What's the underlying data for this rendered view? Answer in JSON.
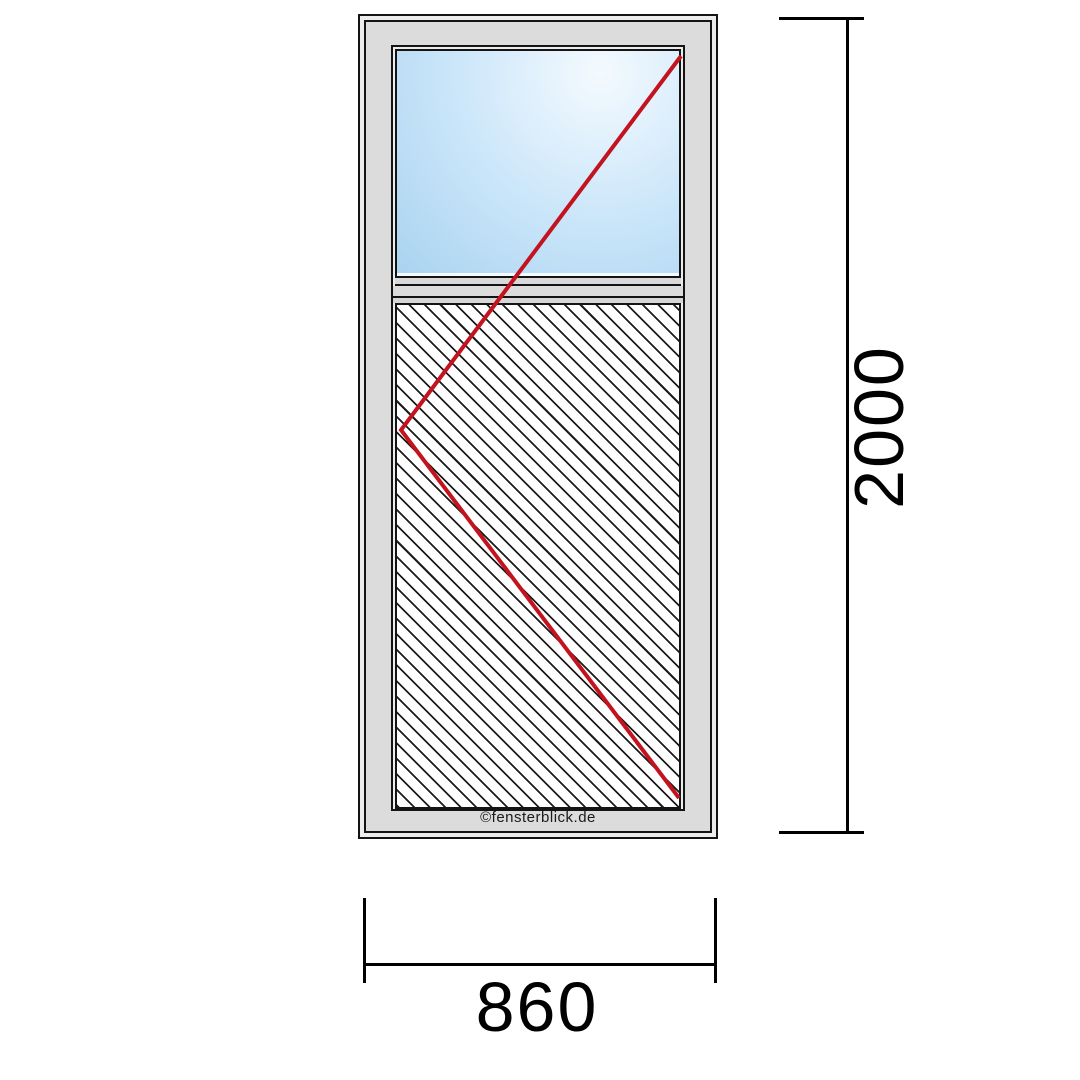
{
  "drawing": {
    "type": "window-element-technical-drawing",
    "watermark": "©fensterblick.de",
    "panes": {
      "upper": "glass-pane",
      "lower": "hatched-infill-panel"
    },
    "opening_lines": {
      "points": "681,56 401,430 679,798",
      "color": "#c2131f"
    },
    "colors": {
      "frame_face": "#dcdcdc",
      "frame_highlight": "#ececec",
      "outline": "#141414",
      "glass_light": "#f4fafe",
      "glass_mid": "#cde7fa",
      "glass_deep": "#a9d3f0",
      "hatch_line": "#1c1c1c",
      "dimension": "#000000"
    },
    "dimensions": {
      "height": {
        "value": "2000"
      },
      "width": {
        "value": "860"
      }
    }
  }
}
